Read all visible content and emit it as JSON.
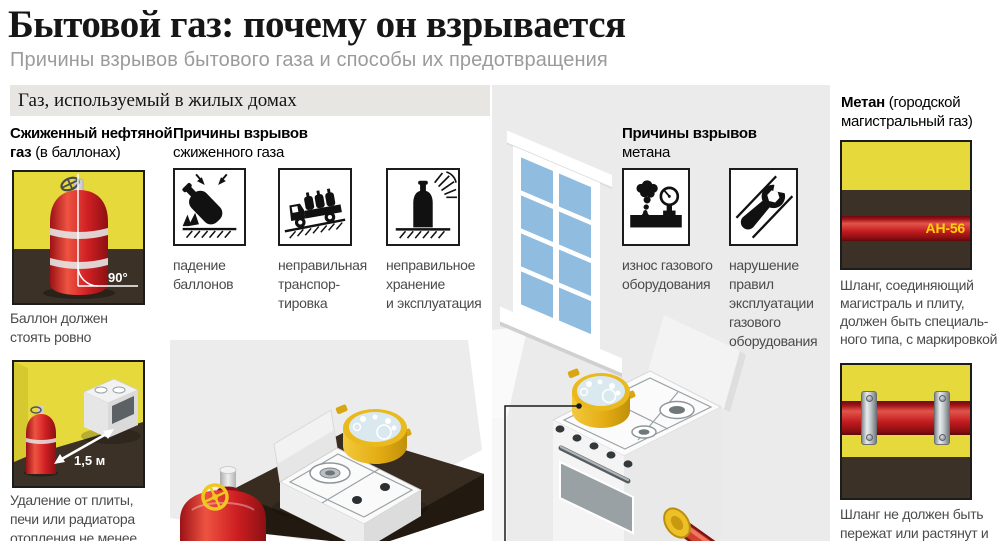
{
  "header": {
    "title": "Бытовой газ: почему он взрывается",
    "subtitle": "Причины взрывов бытового газа и способы их предотвращения",
    "band": "Газ, используемый в жилых домах"
  },
  "lpg": {
    "heading": {
      "line1_bold": "Сжиженный нефтяной",
      "line2_bold": "газ",
      "line2_rest": "(в баллонах)"
    },
    "fig_upright": {
      "angle_label": "90°",
      "caption": [
        "Баллон должен",
        "стоять ровно"
      ]
    },
    "fig_distance": {
      "distance_label": "1,5 м",
      "caption": [
        "Удаление от плиты,",
        "печи или радиатора",
        "отопления не менее"
      ]
    }
  },
  "lpg_causes": {
    "title_bold": "Причины взрывов",
    "title_rest": "сжиженного газа",
    "items": [
      {
        "icon": "falling-cylinder-icon",
        "caption": [
          "падение",
          "баллонов"
        ]
      },
      {
        "icon": "truck-transport-icon",
        "caption": [
          "неправильная",
          "транспор-",
          "тировка"
        ]
      },
      {
        "icon": "sun-heat-storage-icon",
        "caption": [
          "неправильное",
          "хранение",
          "и эксплуатация"
        ]
      }
    ]
  },
  "methane_causes": {
    "title_bold": "Причины взрывов",
    "title_rest": "метана",
    "items": [
      {
        "icon": "gas-leak-gauge-icon",
        "caption": [
          "износ газового",
          "оборудования"
        ]
      },
      {
        "icon": "wrench-icon",
        "caption": [
          "нарушение",
          "правил",
          "эксплуатации",
          "газового",
          "оборудования"
        ]
      }
    ]
  },
  "methane": {
    "heading": {
      "bold": "Метан",
      "line1_rest": "(городской",
      "line2": "магистральный газ)"
    },
    "fig_hose_marking": {
      "label": "АН-56",
      "caption": [
        "Шланг, соединяющий",
        "магистраль и плиту,",
        "должен быть специаль-",
        "ного типа, с маркировкой"
      ]
    },
    "fig_hose_mount": {
      "caption": [
        "Шланг не должен быть",
        "пережат или растянут и"
      ]
    }
  },
  "colors": {
    "band_bg": "#e7e6e2",
    "room_bg": "#ebebeb",
    "scene_bg": "#ececec",
    "wall_yellow": "#e5d93c",
    "floor_dark": "#3b3126",
    "cylinder_red": "#c4201f",
    "window_blue": "#8fbcdf",
    "marking_yellow": "#ffd400",
    "pot_yellow": "#e8b71c"
  }
}
